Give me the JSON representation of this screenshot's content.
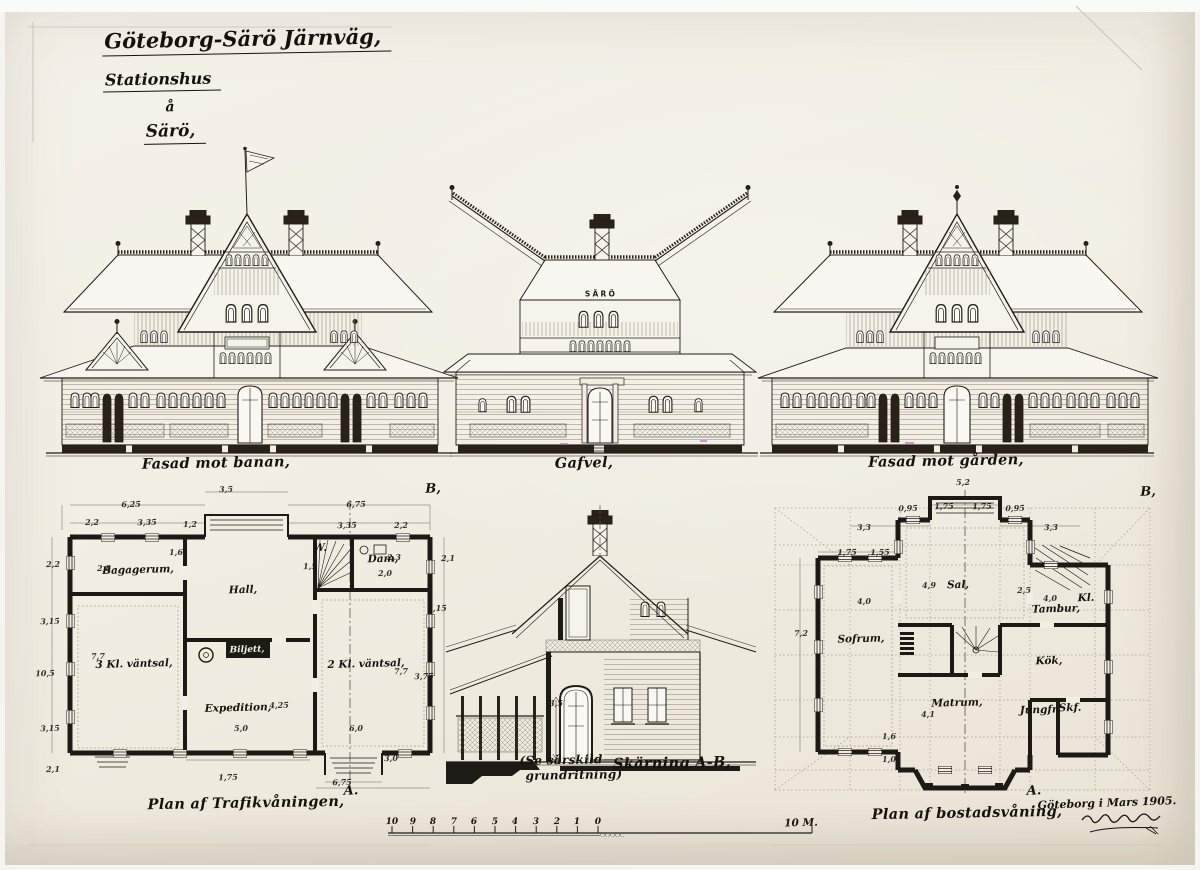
{
  "photo": {
    "paper_color": "#f2eee4",
    "ink_color": "#211d16",
    "artifact_color": "#b55fae"
  },
  "title_block": {
    "line1": "Göteborg-Särö Järnväg,",
    "line2": "Stationshus",
    "line3": "å",
    "line4": "Särö,"
  },
  "elevations": {
    "left": {
      "caption": "Fasad mot banan,"
    },
    "center": {
      "caption": "Gafvel,",
      "sign": "SÄRÖ"
    },
    "right": {
      "caption": "Fasad mot gården,"
    }
  },
  "section": {
    "caption": "Skärning A-B,",
    "note_line1": "(Se särskild",
    "note_line2": "grundritning)"
  },
  "plans": {
    "trafik": {
      "caption": "Plan af Trafikvåningen,",
      "rooms": [
        {
          "text": "Bagagerum,",
          "x": 138,
          "y": 570
        },
        {
          "text": "Hall,",
          "x": 243,
          "y": 590
        },
        {
          "text": "3 Kl. väntsal,",
          "x": 134,
          "y": 664
        },
        {
          "text": "Biljett,",
          "x": 247,
          "y": 650,
          "cls": "inv"
        },
        {
          "text": "Expedition,",
          "x": 238,
          "y": 708
        },
        {
          "text": "2 Kl. väntsal,",
          "x": 366,
          "y": 664
        },
        {
          "text": "Dam,",
          "x": 383,
          "y": 559
        },
        {
          "text": "W.",
          "x": 320,
          "y": 548
        }
      ]
    },
    "bostad": {
      "caption": "Plan af bostadsvåning,",
      "rooms": [
        {
          "text": "Sal,",
          "x": 958,
          "y": 585
        },
        {
          "text": "Sofrum,",
          "x": 861,
          "y": 639
        },
        {
          "text": "Tambur,",
          "x": 1056,
          "y": 609
        },
        {
          "text": "Kl.",
          "x": 1086,
          "y": 598
        },
        {
          "text": "Kök,",
          "x": 1049,
          "y": 661
        },
        {
          "text": "Matrum,",
          "x": 957,
          "y": 703
        },
        {
          "text": "Jungfr.",
          "x": 1040,
          "y": 710
        },
        {
          "text": "Skf.",
          "x": 1070,
          "y": 708
        }
      ]
    }
  },
  "markers": [
    {
      "text": "B,",
      "x": 433,
      "y": 489
    },
    {
      "text": "A.",
      "x": 351,
      "y": 791
    },
    {
      "text": "B,",
      "x": 1148,
      "y": 492
    },
    {
      "text": "A.",
      "x": 1034,
      "y": 791
    }
  ],
  "dimensions": [
    {
      "text": "3,5",
      "x": 226,
      "y": 489
    },
    {
      "text": "6,25",
      "x": 131,
      "y": 504
    },
    {
      "text": "6,75",
      "x": 356,
      "y": 504
    },
    {
      "text": "2,2",
      "x": 92,
      "y": 522
    },
    {
      "text": "3,35",
      "x": 147,
      "y": 522
    },
    {
      "text": "1,2",
      "x": 190,
      "y": 524
    },
    {
      "text": "3,35",
      "x": 347,
      "y": 525
    },
    {
      "text": "2,2",
      "x": 401,
      "y": 525
    },
    {
      "text": "2,2",
      "x": 53,
      "y": 564
    },
    {
      "text": "3,15",
      "x": 50,
      "y": 621
    },
    {
      "text": "10,5",
      "x": 45,
      "y": 673
    },
    {
      "text": "3,15",
      "x": 50,
      "y": 728
    },
    {
      "text": "2,1",
      "x": 53,
      "y": 769
    },
    {
      "text": "2,8",
      "x": 104,
      "y": 568
    },
    {
      "text": "1,6",
      "x": 176,
      "y": 552
    },
    {
      "text": "7,7",
      "x": 98,
      "y": 656
    },
    {
      "text": "7,7",
      "x": 401,
      "y": 671
    },
    {
      "text": "3,75",
      "x": 424,
      "y": 676
    },
    {
      "text": "2,1",
      "x": 448,
      "y": 558
    },
    {
      "text": "3,15",
      "x": 437,
      "y": 608
    },
    {
      "text": "2,3",
      "x": 394,
      "y": 557
    },
    {
      "text": "2,0",
      "x": 385,
      "y": 573
    },
    {
      "text": "1,5",
      "x": 310,
      "y": 566
    },
    {
      "text": "4,25",
      "x": 279,
      "y": 705
    },
    {
      "text": "5,0",
      "x": 241,
      "y": 728
    },
    {
      "text": "6,0",
      "x": 356,
      "y": 728
    },
    {
      "text": "3,0",
      "x": 391,
      "y": 758
    },
    {
      "text": "1,75",
      "x": 228,
      "y": 777
    },
    {
      "text": "6,75",
      "x": 342,
      "y": 782
    },
    {
      "text": "3,5",
      "x": 556,
      "y": 703
    },
    {
      "text": "5,2",
      "x": 963,
      "y": 482
    },
    {
      "text": "0,95",
      "x": 908,
      "y": 508
    },
    {
      "text": "1,75",
      "x": 944,
      "y": 506
    },
    {
      "text": "1,75",
      "x": 982,
      "y": 506
    },
    {
      "text": "0,95",
      "x": 1015,
      "y": 508
    },
    {
      "text": "3,3",
      "x": 864,
      "y": 527
    },
    {
      "text": "3,3",
      "x": 1051,
      "y": 527
    },
    {
      "text": "1,75",
      "x": 847,
      "y": 552
    },
    {
      "text": "1,55",
      "x": 880,
      "y": 552
    },
    {
      "text": "4,0",
      "x": 864,
      "y": 601
    },
    {
      "text": "4,9",
      "x": 929,
      "y": 585
    },
    {
      "text": "2,5",
      "x": 1024,
      "y": 590
    },
    {
      "text": "4,0",
      "x": 1050,
      "y": 598
    },
    {
      "text": "7,2",
      "x": 801,
      "y": 633
    },
    {
      "text": "4,1",
      "x": 928,
      "y": 714
    },
    {
      "text": "1,6",
      "x": 889,
      "y": 736
    },
    {
      "text": "1,0",
      "x": 889,
      "y": 759
    }
  ],
  "scale_bar": {
    "ticks": [
      {
        "text": "10",
        "x": 392,
        "y": 822
      },
      {
        "text": "9",
        "x": 413,
        "y": 822
      },
      {
        "text": "8",
        "x": 433,
        "y": 822
      },
      {
        "text": "7",
        "x": 454,
        "y": 822
      },
      {
        "text": "6",
        "x": 474,
        "y": 822
      },
      {
        "text": "5",
        "x": 495,
        "y": 822
      },
      {
        "text": "4",
        "x": 515,
        "y": 822
      },
      {
        "text": "3",
        "x": 536,
        "y": 822
      },
      {
        "text": "2",
        "x": 557,
        "y": 822
      },
      {
        "text": "1",
        "x": 577,
        "y": 822
      },
      {
        "text": "0",
        "x": 598,
        "y": 822
      },
      {
        "text": "10 M.",
        "x": 801,
        "y": 823,
        "cls": "unit"
      }
    ]
  },
  "signature": {
    "place_date": "Göteborg i Mars 1905."
  }
}
